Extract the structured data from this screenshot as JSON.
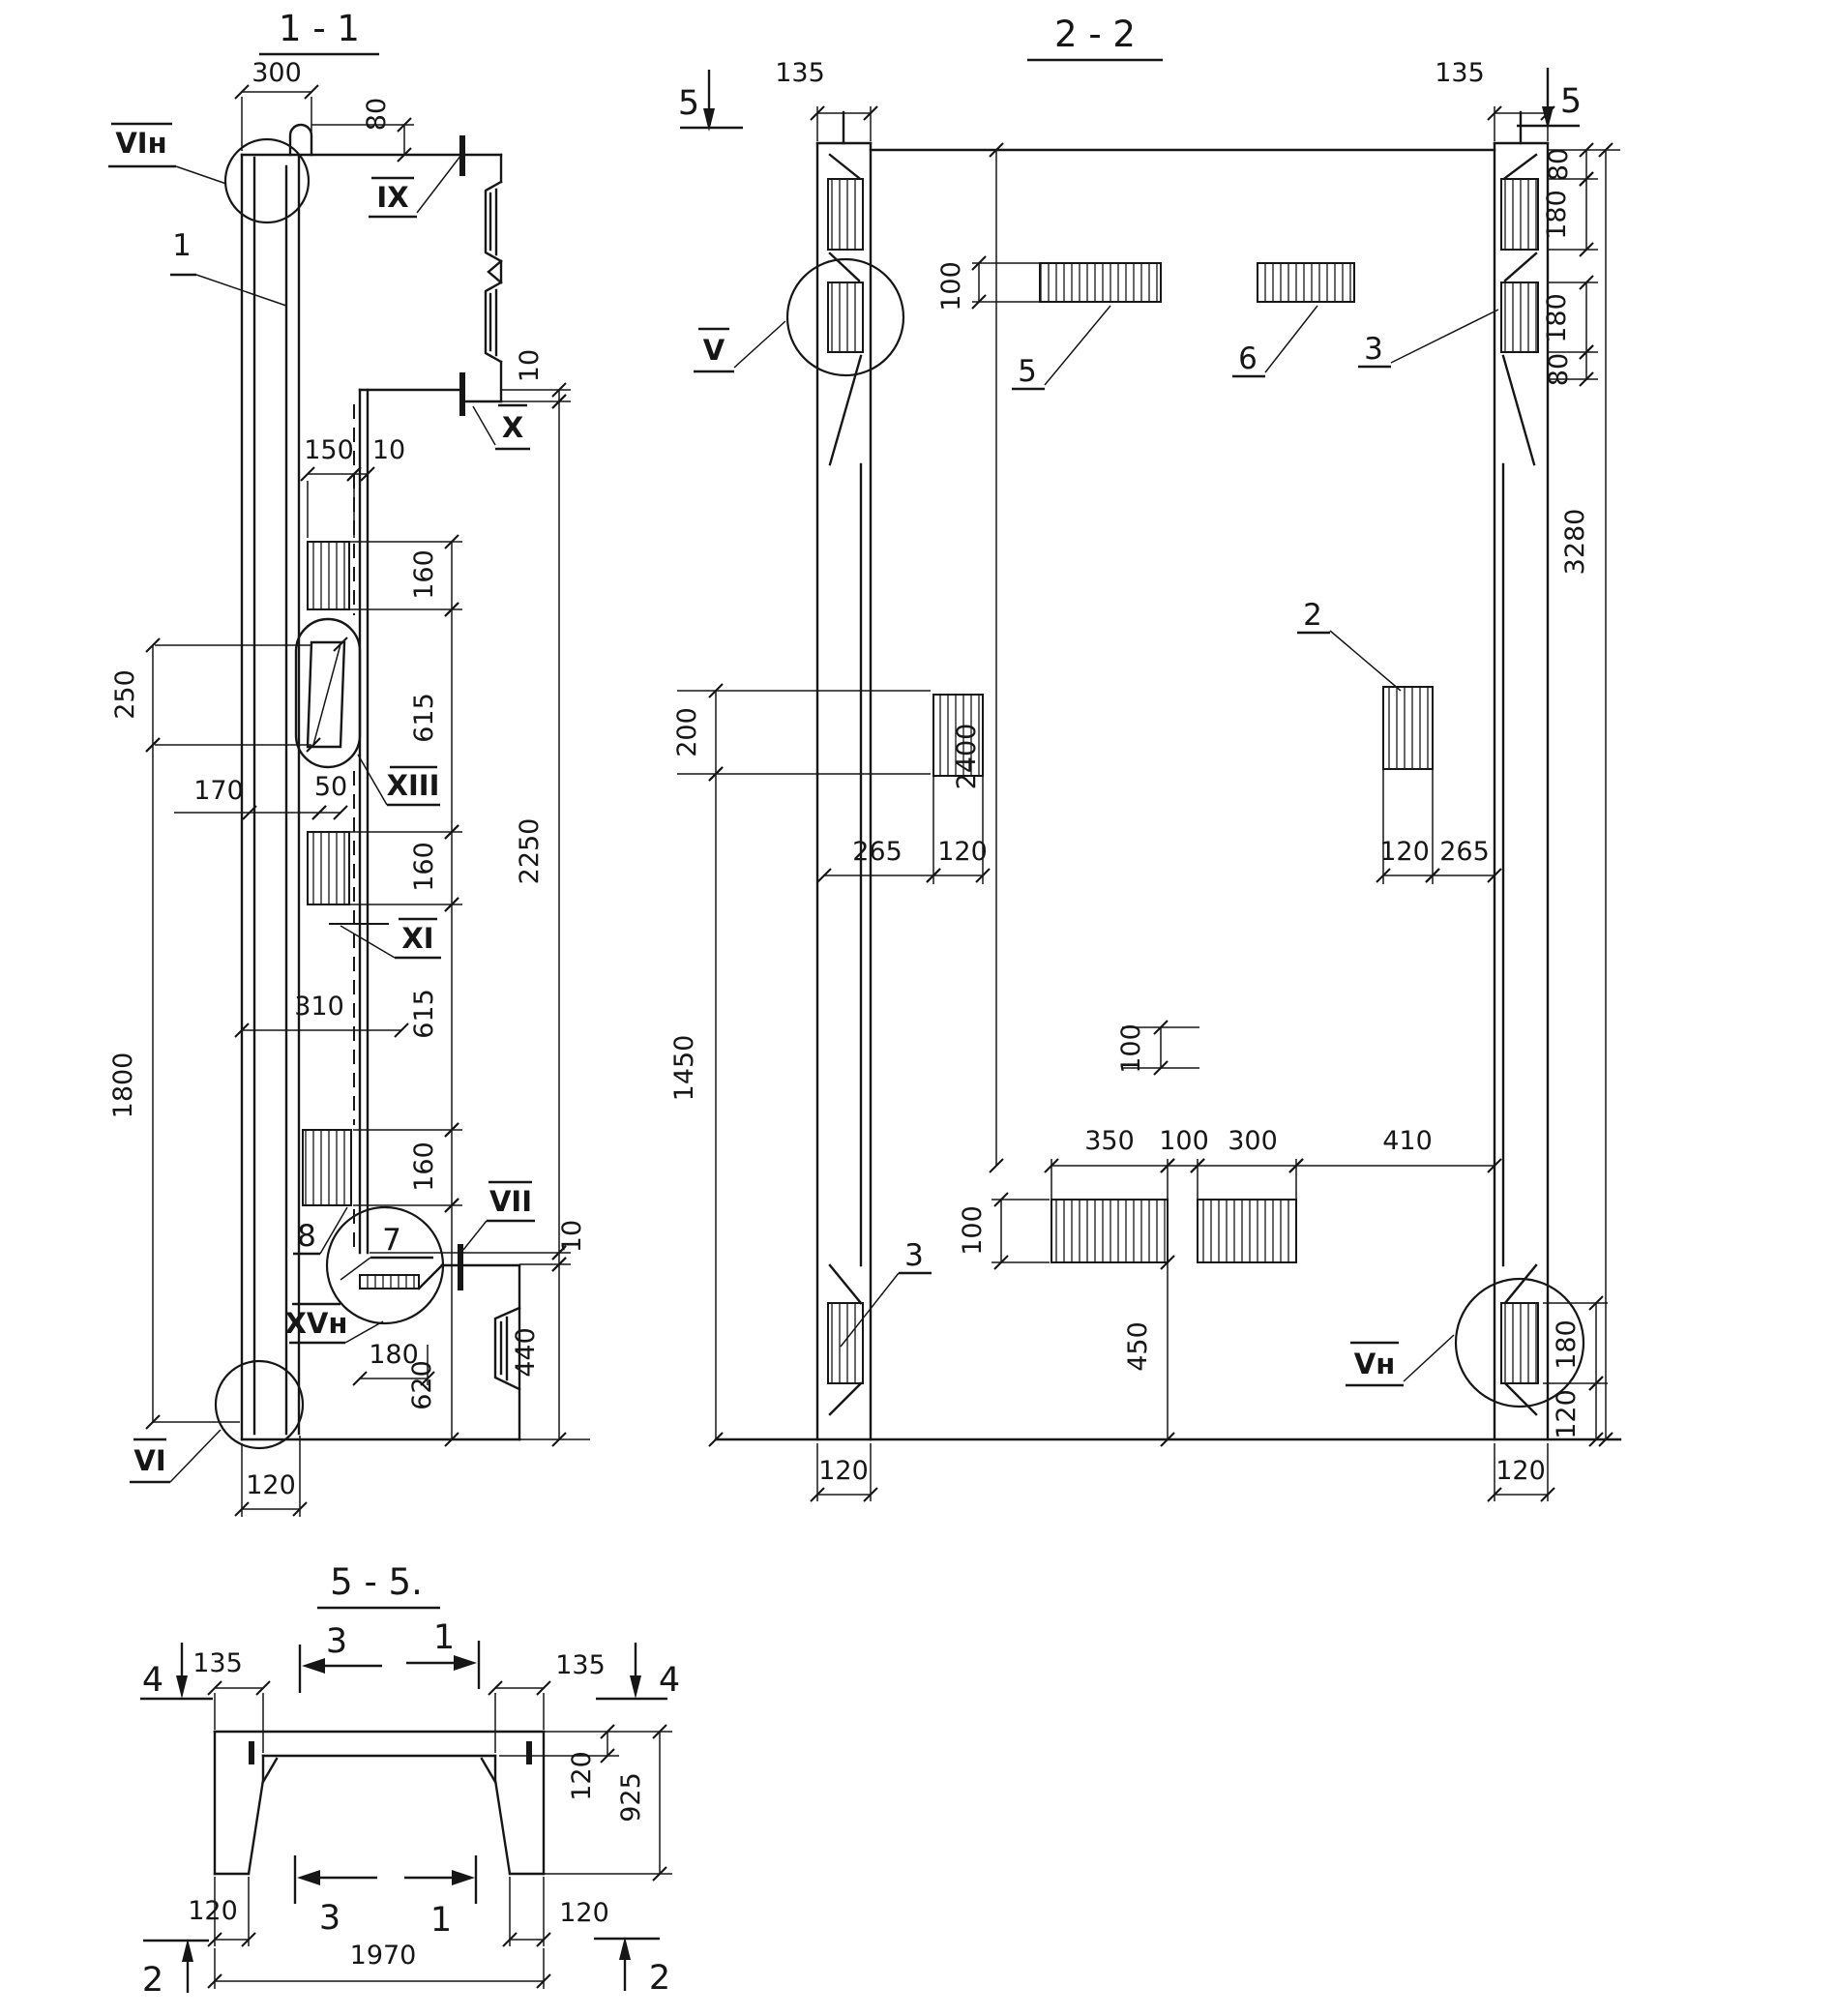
{
  "colors": {
    "ink": "#161616",
    "paper": "#ffffff"
  },
  "s11": {
    "title": "1 - 1",
    "labels": {
      "vi_top": "VIн",
      "ix": "IX",
      "x": "X",
      "xiii": "XIII",
      "xi": "XI",
      "vii": "VII",
      "xv": "XVн",
      "vi": "VI",
      "pos1": "1",
      "pos7": "7",
      "pos8": "8"
    },
    "dims": {
      "d300": "300",
      "d80": "80",
      "d10": "10",
      "d150": "150",
      "d160": "160",
      "d615": "615",
      "d2250": "2250",
      "d250": "250",
      "d170": "170",
      "d50": "50",
      "d310": "310",
      "d1800": "1800",
      "d120": "120",
      "d180": "180",
      "d620": "620",
      "d440": "440"
    }
  },
  "s22": {
    "title": "2 - 2",
    "markers": {
      "m5": "5"
    },
    "labels": {
      "v": "V",
      "vn": "Vн",
      "pos2": "2",
      "pos3": "3",
      "pos5": "5",
      "pos6": "6"
    },
    "dims": {
      "d135": "135",
      "d80": "80",
      "d180": "180",
      "d100": "100",
      "d200": "200",
      "d2400": "2400",
      "d3280": "3280",
      "d265": "265",
      "d120": "120",
      "d1450": "1450",
      "d350": "350",
      "d300": "300",
      "d410": "410",
      "d450": "450"
    }
  },
  "s55": {
    "title": "5 - 5.",
    "markers": {
      "m4": "4",
      "m2": "2",
      "m3": "3",
      "m1": "1"
    },
    "dims": {
      "d135": "135",
      "d120": "120",
      "d925": "925",
      "d1970": "1970"
    }
  }
}
